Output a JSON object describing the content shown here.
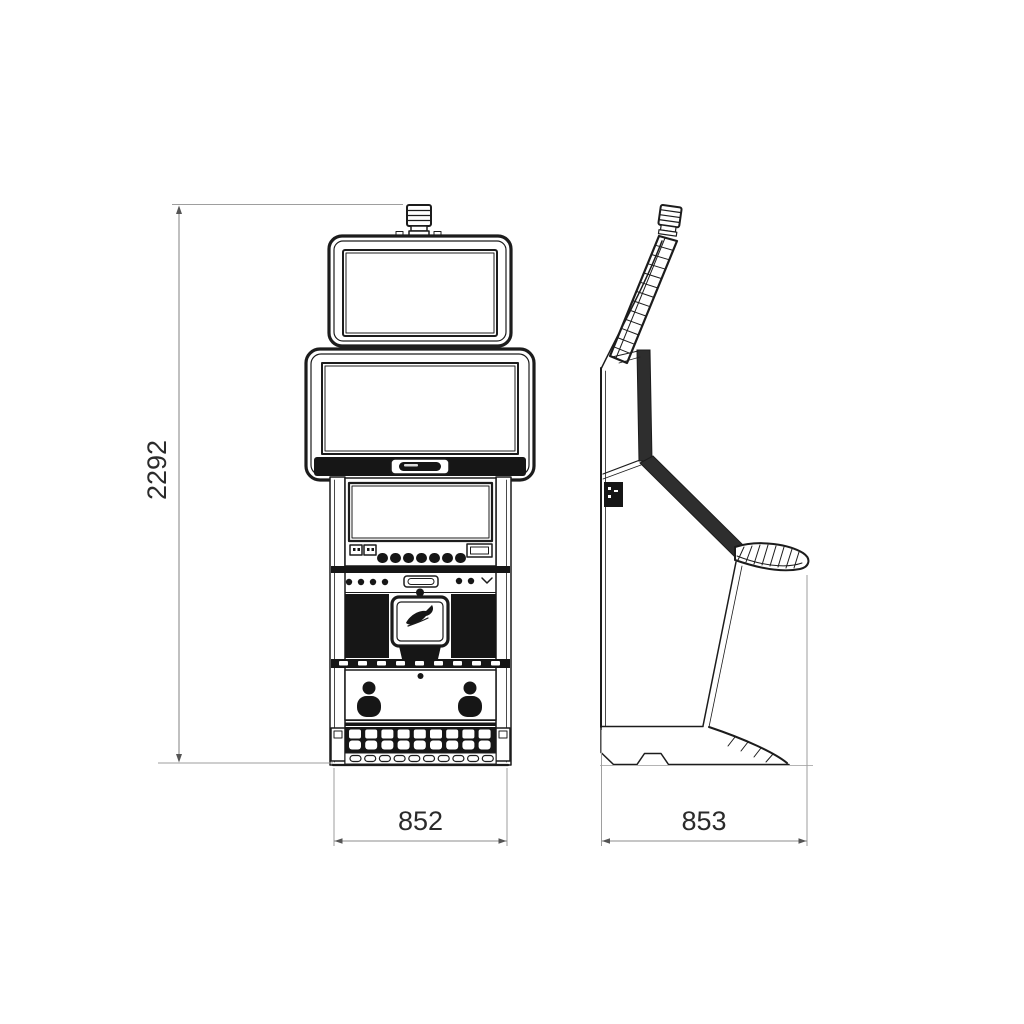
{
  "drawing": {
    "dimensions": {
      "height": "2292",
      "front_width": "852",
      "side_depth": "853"
    },
    "icons": {
      "emblem": "bird-swoosh-emblem",
      "beacon": "tower-light-icon"
    },
    "colors": {
      "line": "#1c1c1c",
      "dark_fill": "#161616",
      "side_dark": "#2e2e2e",
      "dim_line": "#8c8c8c",
      "ext_line": "#9e9e9e",
      "text": "#2b2b2b",
      "background": "#ffffff"
    }
  }
}
